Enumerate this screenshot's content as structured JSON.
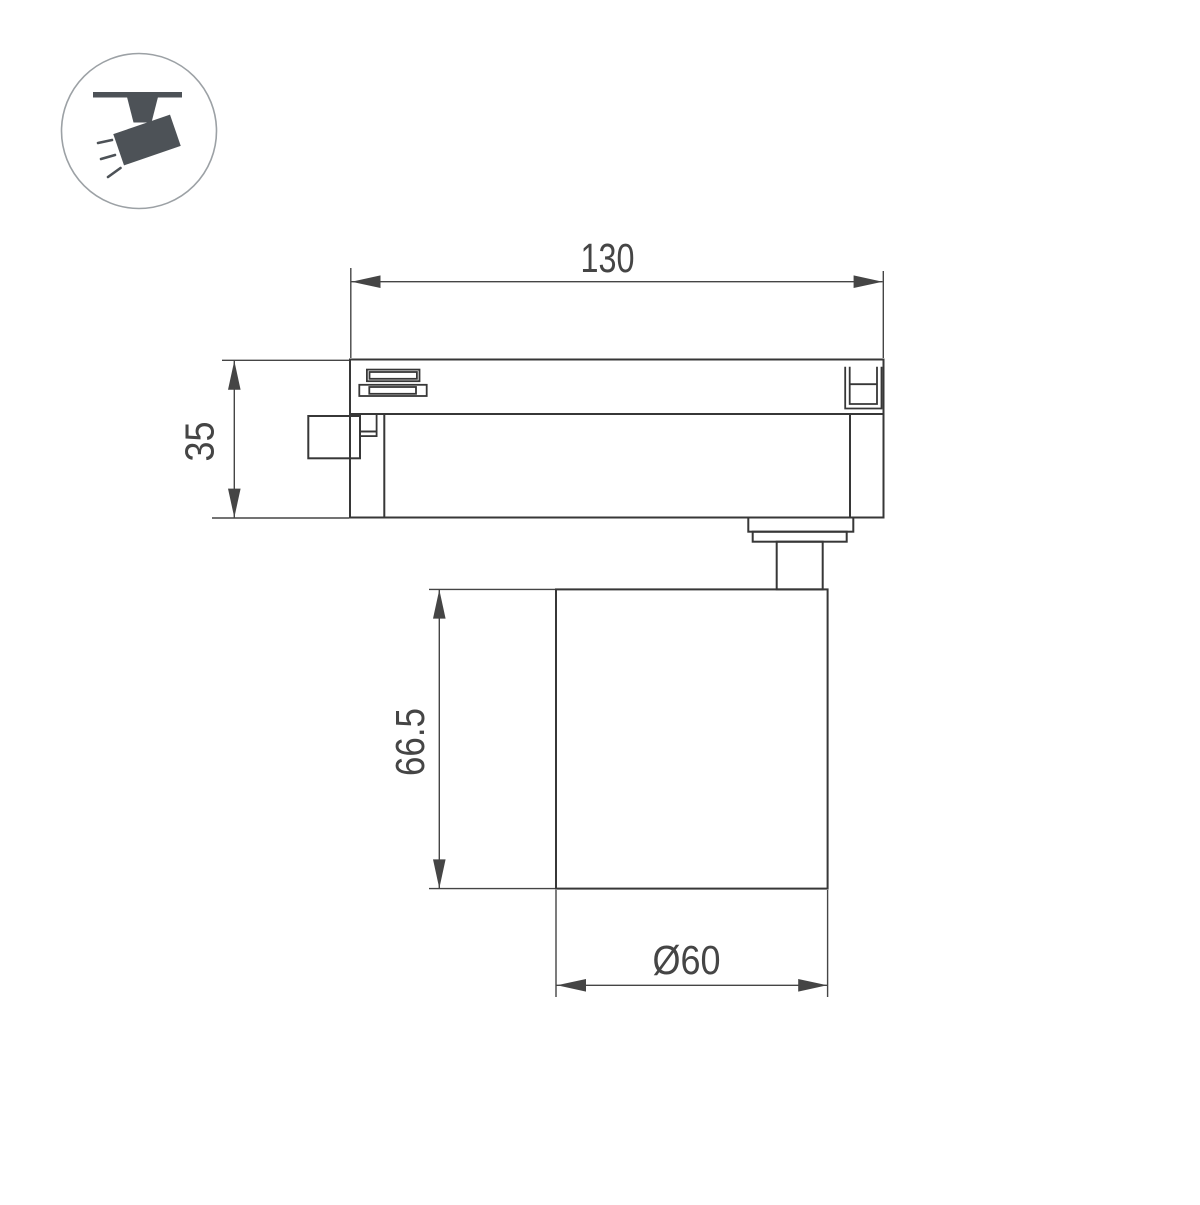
{
  "page": {
    "background": "#ffffff",
    "type_label": "technical dimension drawing"
  },
  "icon": {
    "name": "track-spotlight-icon",
    "fill": "#4d5257",
    "circle_stroke": "#9ca1a5"
  },
  "drawing": {
    "line_color": "#373737",
    "dimension_color": "#454545",
    "dimensions": [
      {
        "id": "track-adapter-width",
        "label": "130"
      },
      {
        "id": "track-adapter-height",
        "label": "35"
      },
      {
        "id": "lamp-body-height",
        "label": "66.5"
      },
      {
        "id": "lamp-body-diameter",
        "label": "Ø60"
      }
    ]
  }
}
